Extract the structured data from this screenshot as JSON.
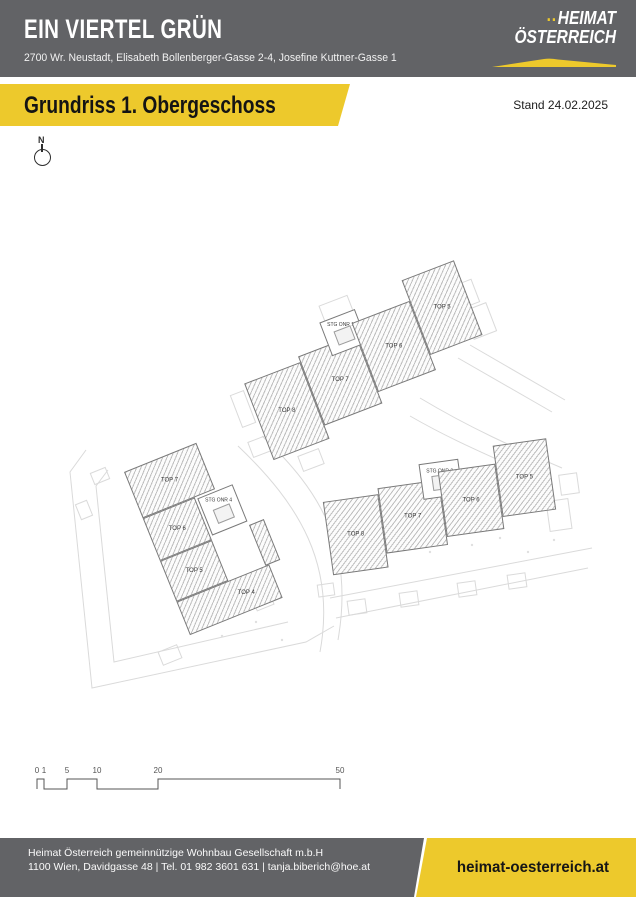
{
  "header": {
    "title": "EIN VIERTEL GRÜN",
    "address": "2700 Wr. Neustadt, Elisabeth Bollenberger-Gasse 2-4, Josefine Kuttner-Gasse 1",
    "logo_dots": "..",
    "logo_line1": "HEIMAT",
    "logo_line2": "ÖSTERREICH"
  },
  "banner": {
    "title": "Grundriss 1. Obergeschoss",
    "stand": "Stand 24.02.2025"
  },
  "compass": {
    "label": "N"
  },
  "plan": {
    "buildings": [
      {
        "id": "building-upper",
        "units": [
          {
            "label": "TOP 8"
          },
          {
            "label": "TOP 7"
          },
          {
            "label": "STG ONR 1"
          },
          {
            "label": "TOP 6"
          },
          {
            "label": "TOP 5"
          }
        ]
      },
      {
        "id": "building-lower-left",
        "units": [
          {
            "label": "TOP 7"
          },
          {
            "label": "TOP 6"
          },
          {
            "label": "STG ONR 4"
          },
          {
            "label": "TOP 5"
          },
          {
            "label": "TOP 4"
          }
        ]
      },
      {
        "id": "building-lower-right",
        "units": [
          {
            "label": "TOP 8"
          },
          {
            "label": "TOP 7"
          },
          {
            "label": "STG ONR 2"
          },
          {
            "label": "TOP 6"
          },
          {
            "label": "TOP 5"
          }
        ]
      }
    ]
  },
  "scalebar": {
    "labels": [
      "0",
      "1",
      "5",
      "10",
      "20",
      "50"
    ]
  },
  "footer": {
    "company": "Heimat Österreich gemeinnützige Wohnbau Gesellschaft m.b.H",
    "contact": "1100 Wien, Davidgasse 48 | Tel. 01 982 3601 631 | tanja.biberich@hoe.at",
    "website": "heimat-oesterreich.at"
  },
  "colors": {
    "brand_gray": "#626366",
    "brand_yellow": "#edc92c"
  }
}
